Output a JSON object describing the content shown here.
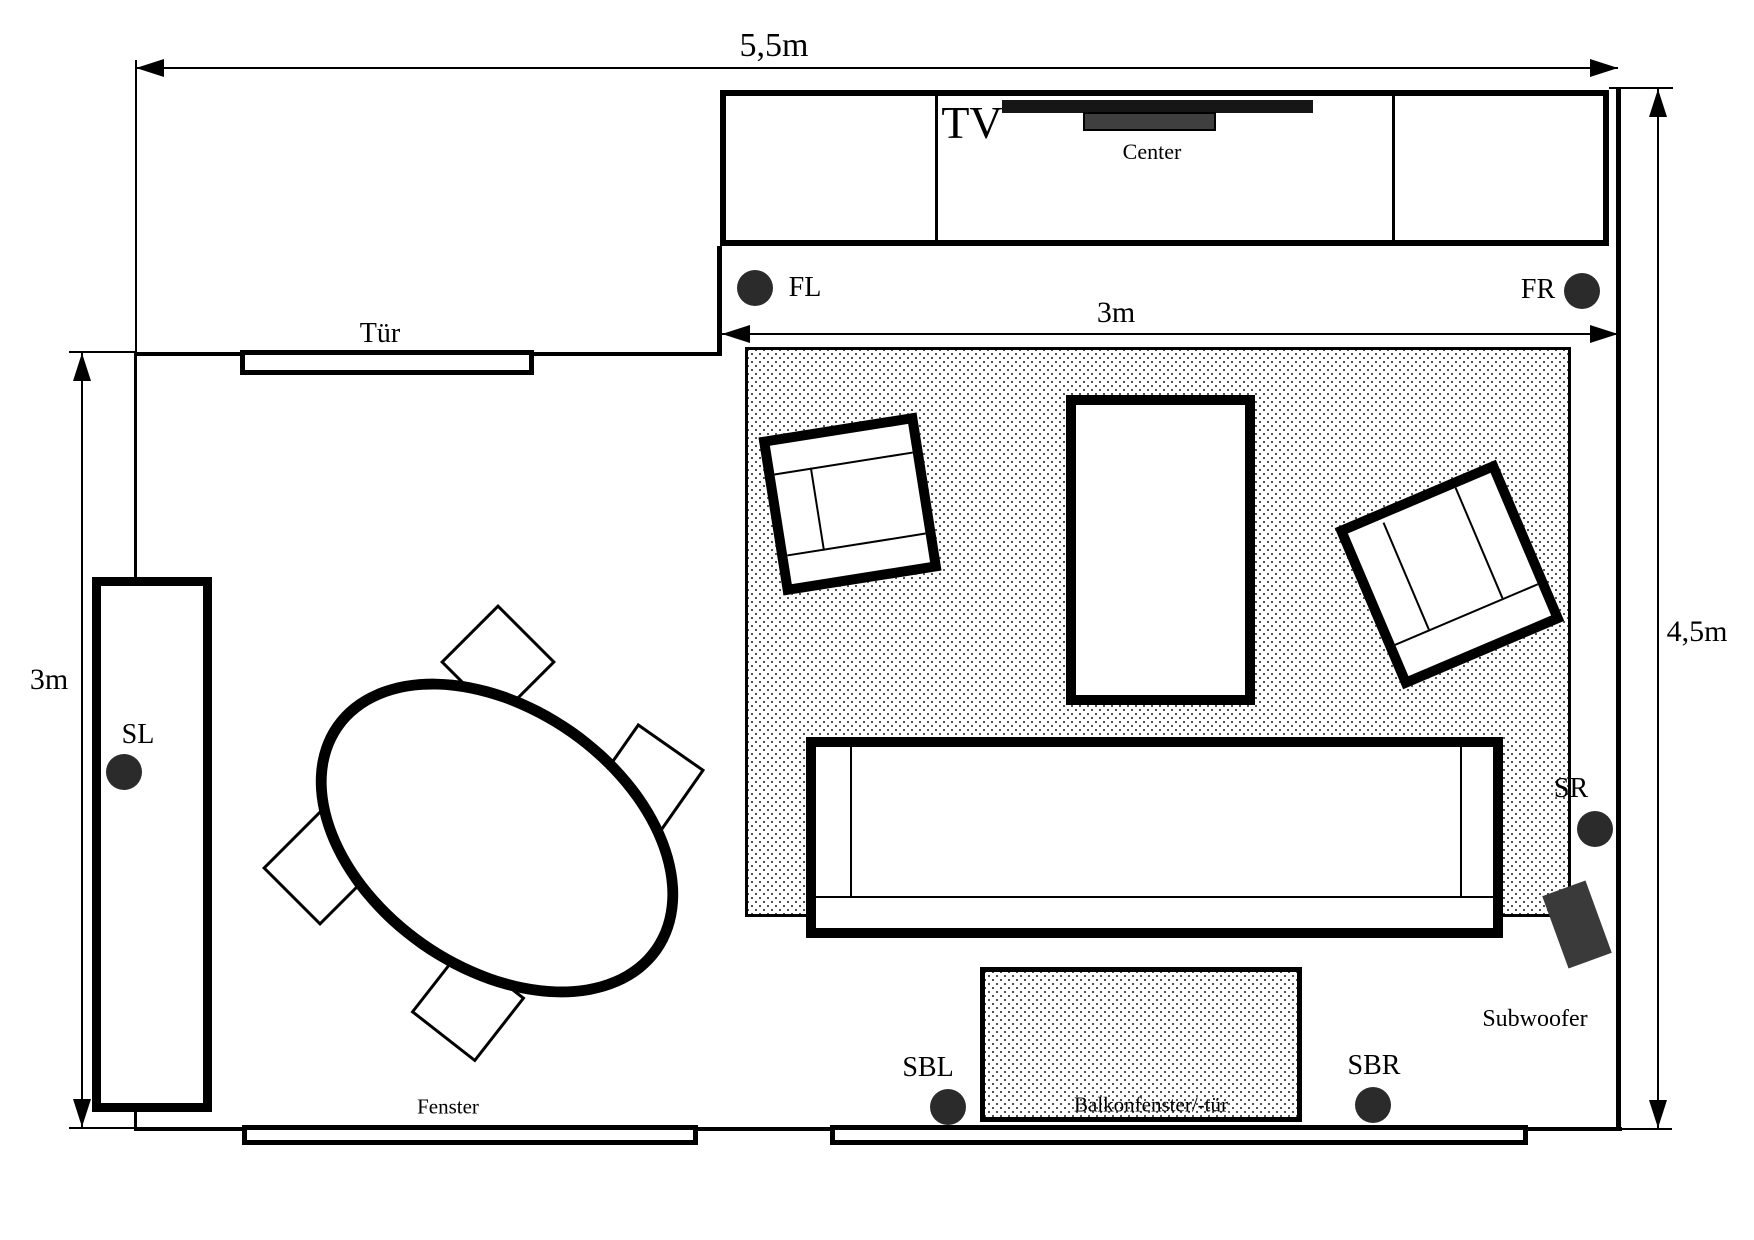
{
  "colors": {
    "ink": "#000000",
    "paper": "#ffffff",
    "speaker_fill": "#2b2b2b",
    "subwoofer_fill": "#3a3a3a",
    "tv_fill": "#161616",
    "center_speaker_fill": "#3f3f3f"
  },
  "dimensions": {
    "room_width": "5,5m",
    "left_height": "3m",
    "carpet_width": "3m",
    "right_height": "4,5m"
  },
  "labels": {
    "tv": "TV",
    "center_speaker": "Center",
    "door": "Tür",
    "window": "Fenster",
    "balcony_door": "Balkonfenster/-tür",
    "subwoofer": "Subwoofer"
  },
  "speakers": [
    {
      "id": "front-left",
      "label": "FL"
    },
    {
      "id": "front-right",
      "label": "FR"
    },
    {
      "id": "surround-left",
      "label": "SL"
    },
    {
      "id": "surround-right",
      "label": "SR"
    },
    {
      "id": "surround-back-left",
      "label": "SBL"
    },
    {
      "id": "surround-back-right",
      "label": "SBR"
    }
  ]
}
